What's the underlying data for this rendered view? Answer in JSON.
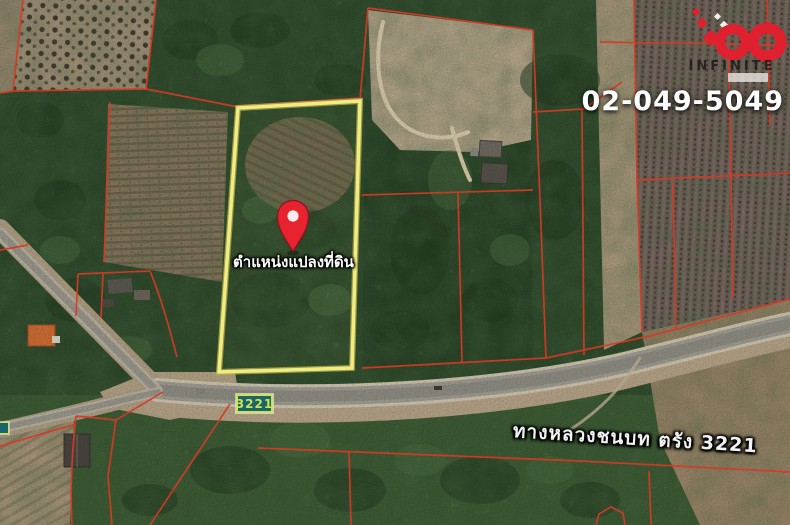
{
  "header": {
    "phone": "02-049-5049"
  },
  "logo": {
    "brand": "INFINITE"
  },
  "map": {
    "marker_label": "ตำแหน่งแปลงที่ดิน",
    "route_shield": "3221",
    "road_label": "ทางหลวงชนบท ตรัง 3221"
  },
  "colors": {
    "parcel_line": "#d63a26",
    "plot_outline": "#efec82",
    "pin_red": "#e82330",
    "shield_bg": "#19646f",
    "shield_text": "#cde24d",
    "logo_red": "#e0202e"
  }
}
